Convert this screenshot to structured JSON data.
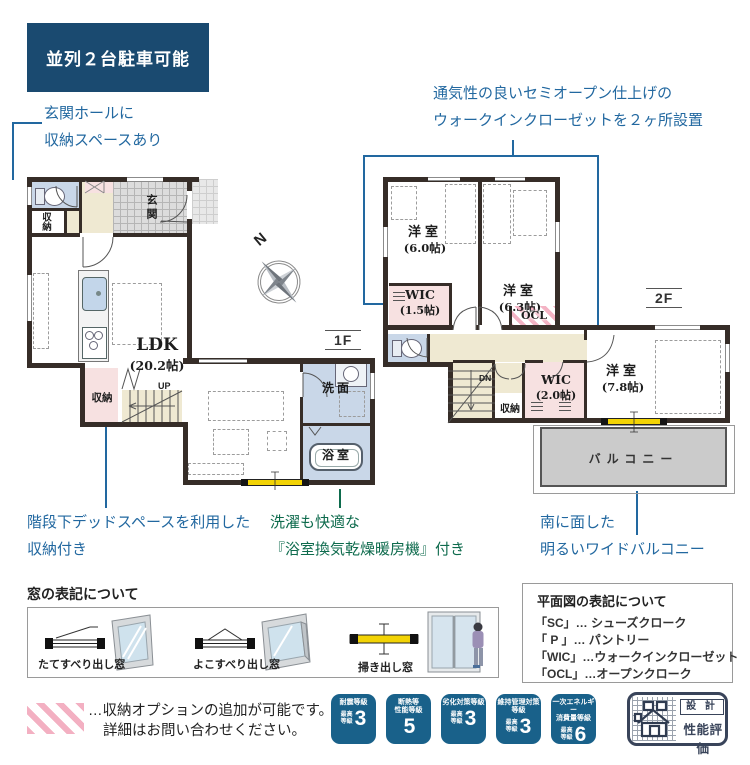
{
  "banner": {
    "label": "並列２台駐車可能"
  },
  "annotations": {
    "entrance": [
      "玄関ホールに",
      "収納スペースあり"
    ],
    "wic": [
      "通気性の良いセミオープン仕上げの",
      "ウォークインクローゼットを２ヶ所設置"
    ],
    "stair_storage": [
      "階段下デッドスペースを利用した",
      "収納付き"
    ],
    "bathroom": [
      "洗濯も快適な",
      "『浴室換気乾燥暖房機』付き"
    ],
    "balcony": [
      "南に面した",
      "明るいワイドバルコニー"
    ]
  },
  "compass": {
    "n": "N"
  },
  "floor1": {
    "tag": "1F",
    "labels": {
      "genkan": "玄関",
      "entry_storage": "収納",
      "ldk": "LDK",
      "ldk_size": "(20.2帖)",
      "under_stair_storage": "収納",
      "up": "UP",
      "washroom": "洗面",
      "bathroom": "浴室"
    }
  },
  "floor2": {
    "tag": "2F",
    "labels": {
      "bed1": "洋室",
      "bed1_size": "(6.0帖)",
      "bed2": "洋室",
      "bed2_size": "(6.3帖)",
      "wic1": "WIC",
      "wic1_size": "(1.5帖)",
      "ocl": "OCL",
      "dn": "DN",
      "storage": "収納",
      "wic2": "WIC",
      "wic2_size": "(2.0帖)",
      "bed3": "洋室",
      "bed3_size": "(7.8帖)",
      "balcony": "バルコニー"
    }
  },
  "window_legend": {
    "title": "窓の表記について",
    "items": [
      {
        "label": "たてすべり出し窓"
      },
      {
        "label": "よこすべり出し窓"
      },
      {
        "label": "掃き出し窓"
      }
    ]
  },
  "plan_legend": {
    "title": "平面図の表記について",
    "items": [
      "「SC」… シューズクローク",
      "「 P 」… パントリー",
      "「WIC」…ウォークインクローゼット",
      "「OCL」…オープンクローク"
    ]
  },
  "option_note": [
    "…収納オプションの追加が可能です。",
    "詳細はお問い合わせください。"
  ],
  "badges": [
    {
      "t1": "耐震等級",
      "t2": "",
      "p1": "最高",
      "p2": "等級",
      "v": "3"
    },
    {
      "t1": "断熱等",
      "t2": "性能等級",
      "p1": "",
      "p2": "",
      "v": "5"
    },
    {
      "t1": "劣化対策等級",
      "t2": "",
      "p1": "最高",
      "p2": "等級",
      "v": "3"
    },
    {
      "t1": "維持管理対策",
      "t2": "等級",
      "p1": "最高",
      "p2": "等級",
      "v": "3"
    },
    {
      "t1": "一次エネルギー",
      "t2": "消費量等級",
      "p1": "最高",
      "p2": "等級",
      "v": "6"
    }
  ],
  "cert_mark": {
    "line1": "設 計",
    "line2": "性能評価"
  },
  "colors": {
    "banner_bg": "#1a4a70",
    "badge_bg": "#19618a",
    "annotation_blue": "#2268a0",
    "annotation_green": "#0e6b4d",
    "wall": "#362d28",
    "wet_room_fill": "#c9d7e8",
    "hall_fill": "#efe9d2",
    "storage_pink": "#f7e1e1",
    "balcony_fill": "#cbcbcb",
    "window_yellow": "#f2d305",
    "hatch_pink": "#f3b0c2"
  }
}
